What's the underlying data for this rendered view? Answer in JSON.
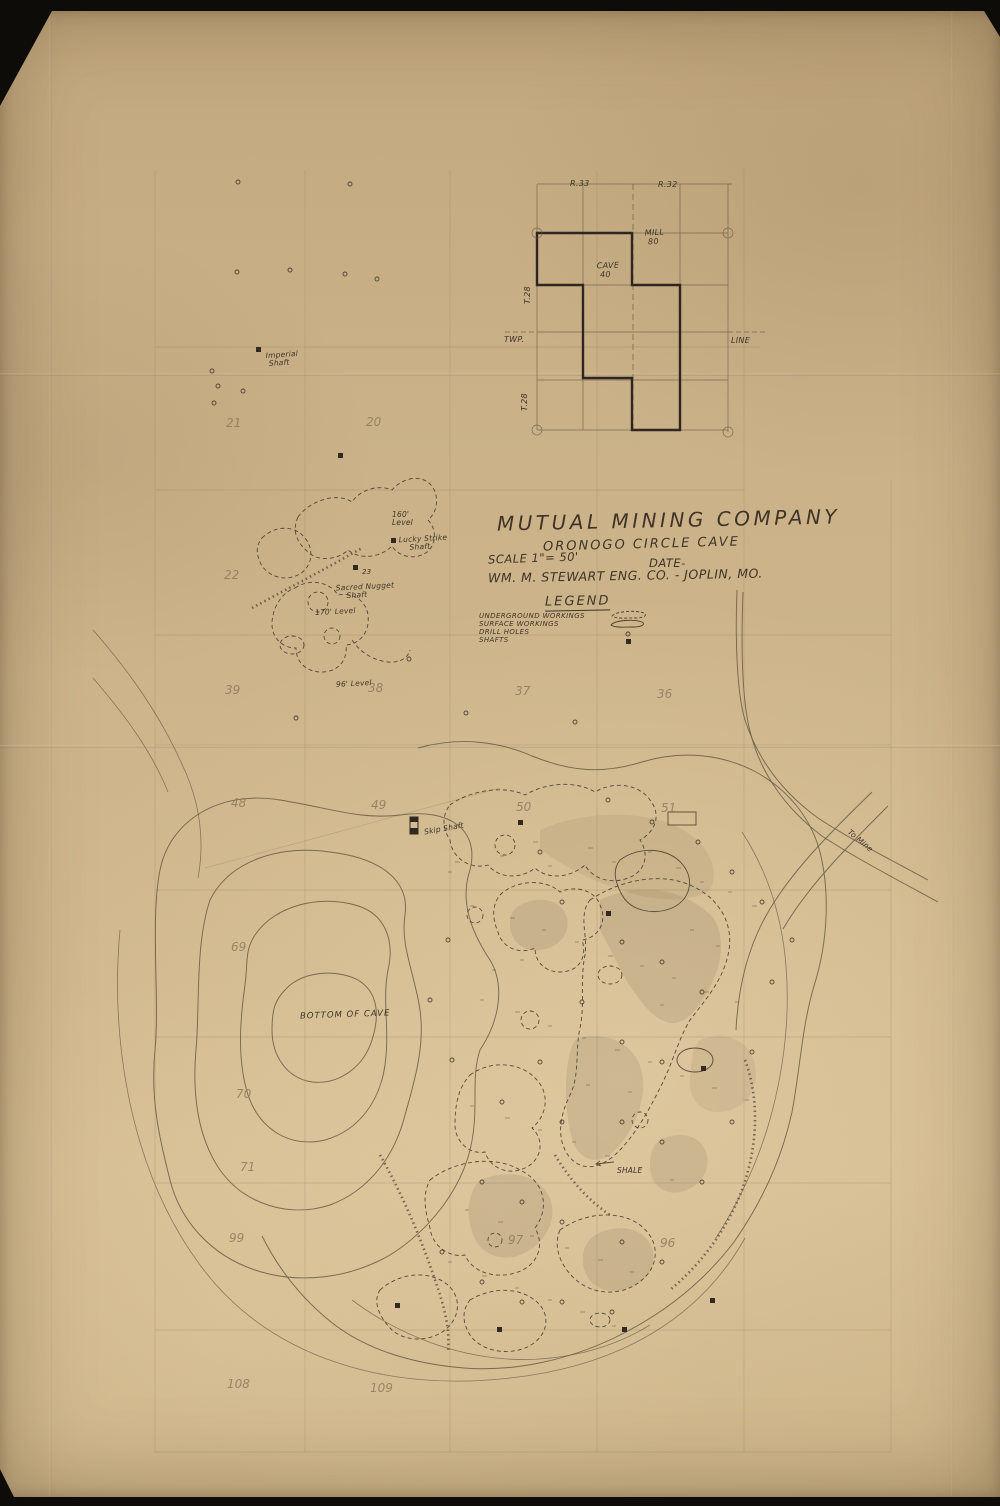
{
  "colors": {
    "paper": "#cfb68c",
    "ink": "#3e3428",
    "pencil": "#8d7b5e",
    "photo_background": "#0e0c09"
  },
  "title_block": {
    "company": "MUTUAL  MINING  COMPANY",
    "cave": "ORONOGO  CIRCLE  CAVE",
    "scale": "SCALE 1\"= 50'",
    "date": "DATE-",
    "engineer": "WM. M. STEWART ENG. CO.  -   JOPLIN, MO."
  },
  "legend": {
    "title": "LEGEND",
    "items": [
      {
        "label": "UNDERGROUND  WORKINGS",
        "symbol": "dashed-outline"
      },
      {
        "label": "SURFACE  WORKINGS",
        "symbol": "solid-outline"
      },
      {
        "label": "DRILL  HOLES",
        "symbol": "small-circle"
      },
      {
        "label": "SHAFTS",
        "symbol": "filled-square"
      }
    ]
  },
  "plat": {
    "range_left": "R.33",
    "range_right": "R.32",
    "twp": "TWP.",
    "line": "LINE",
    "t_upper": "T.28",
    "t_lower": "T.28",
    "cave_tract": "CAVE\n 40",
    "mill_tract": "MILL\n 80"
  },
  "sections": {
    "s21": "21",
    "s20": "20",
    "s22": "22",
    "s39": "39",
    "s38": "38",
    "s37": "37",
    "s36": "36",
    "s48": "48",
    "s49": "49",
    "s50": "50",
    "s51": "51",
    "s69": "69",
    "s70": "70",
    "s71": "71",
    "s99": "99",
    "s97": "97",
    "s96": "96",
    "s108": "108",
    "s109": "109"
  },
  "map_labels": {
    "imperial_shaft": "Imperial\n Shaft",
    "level_160": "160'\nLevel",
    "lucky_strike": "Lucky Strike\n    Shaft",
    "shaft_23": "23",
    "sacred_nugget": "Sacred Nugget\n    Shaft",
    "level_170": "170' Level",
    "level_96": "96' Level",
    "skip_shaft": "Skip Shaft",
    "bottom_of_cave": "BOTTOM  OF  CAVE",
    "shale": "SHALE",
    "to_mine": "To Mine"
  }
}
